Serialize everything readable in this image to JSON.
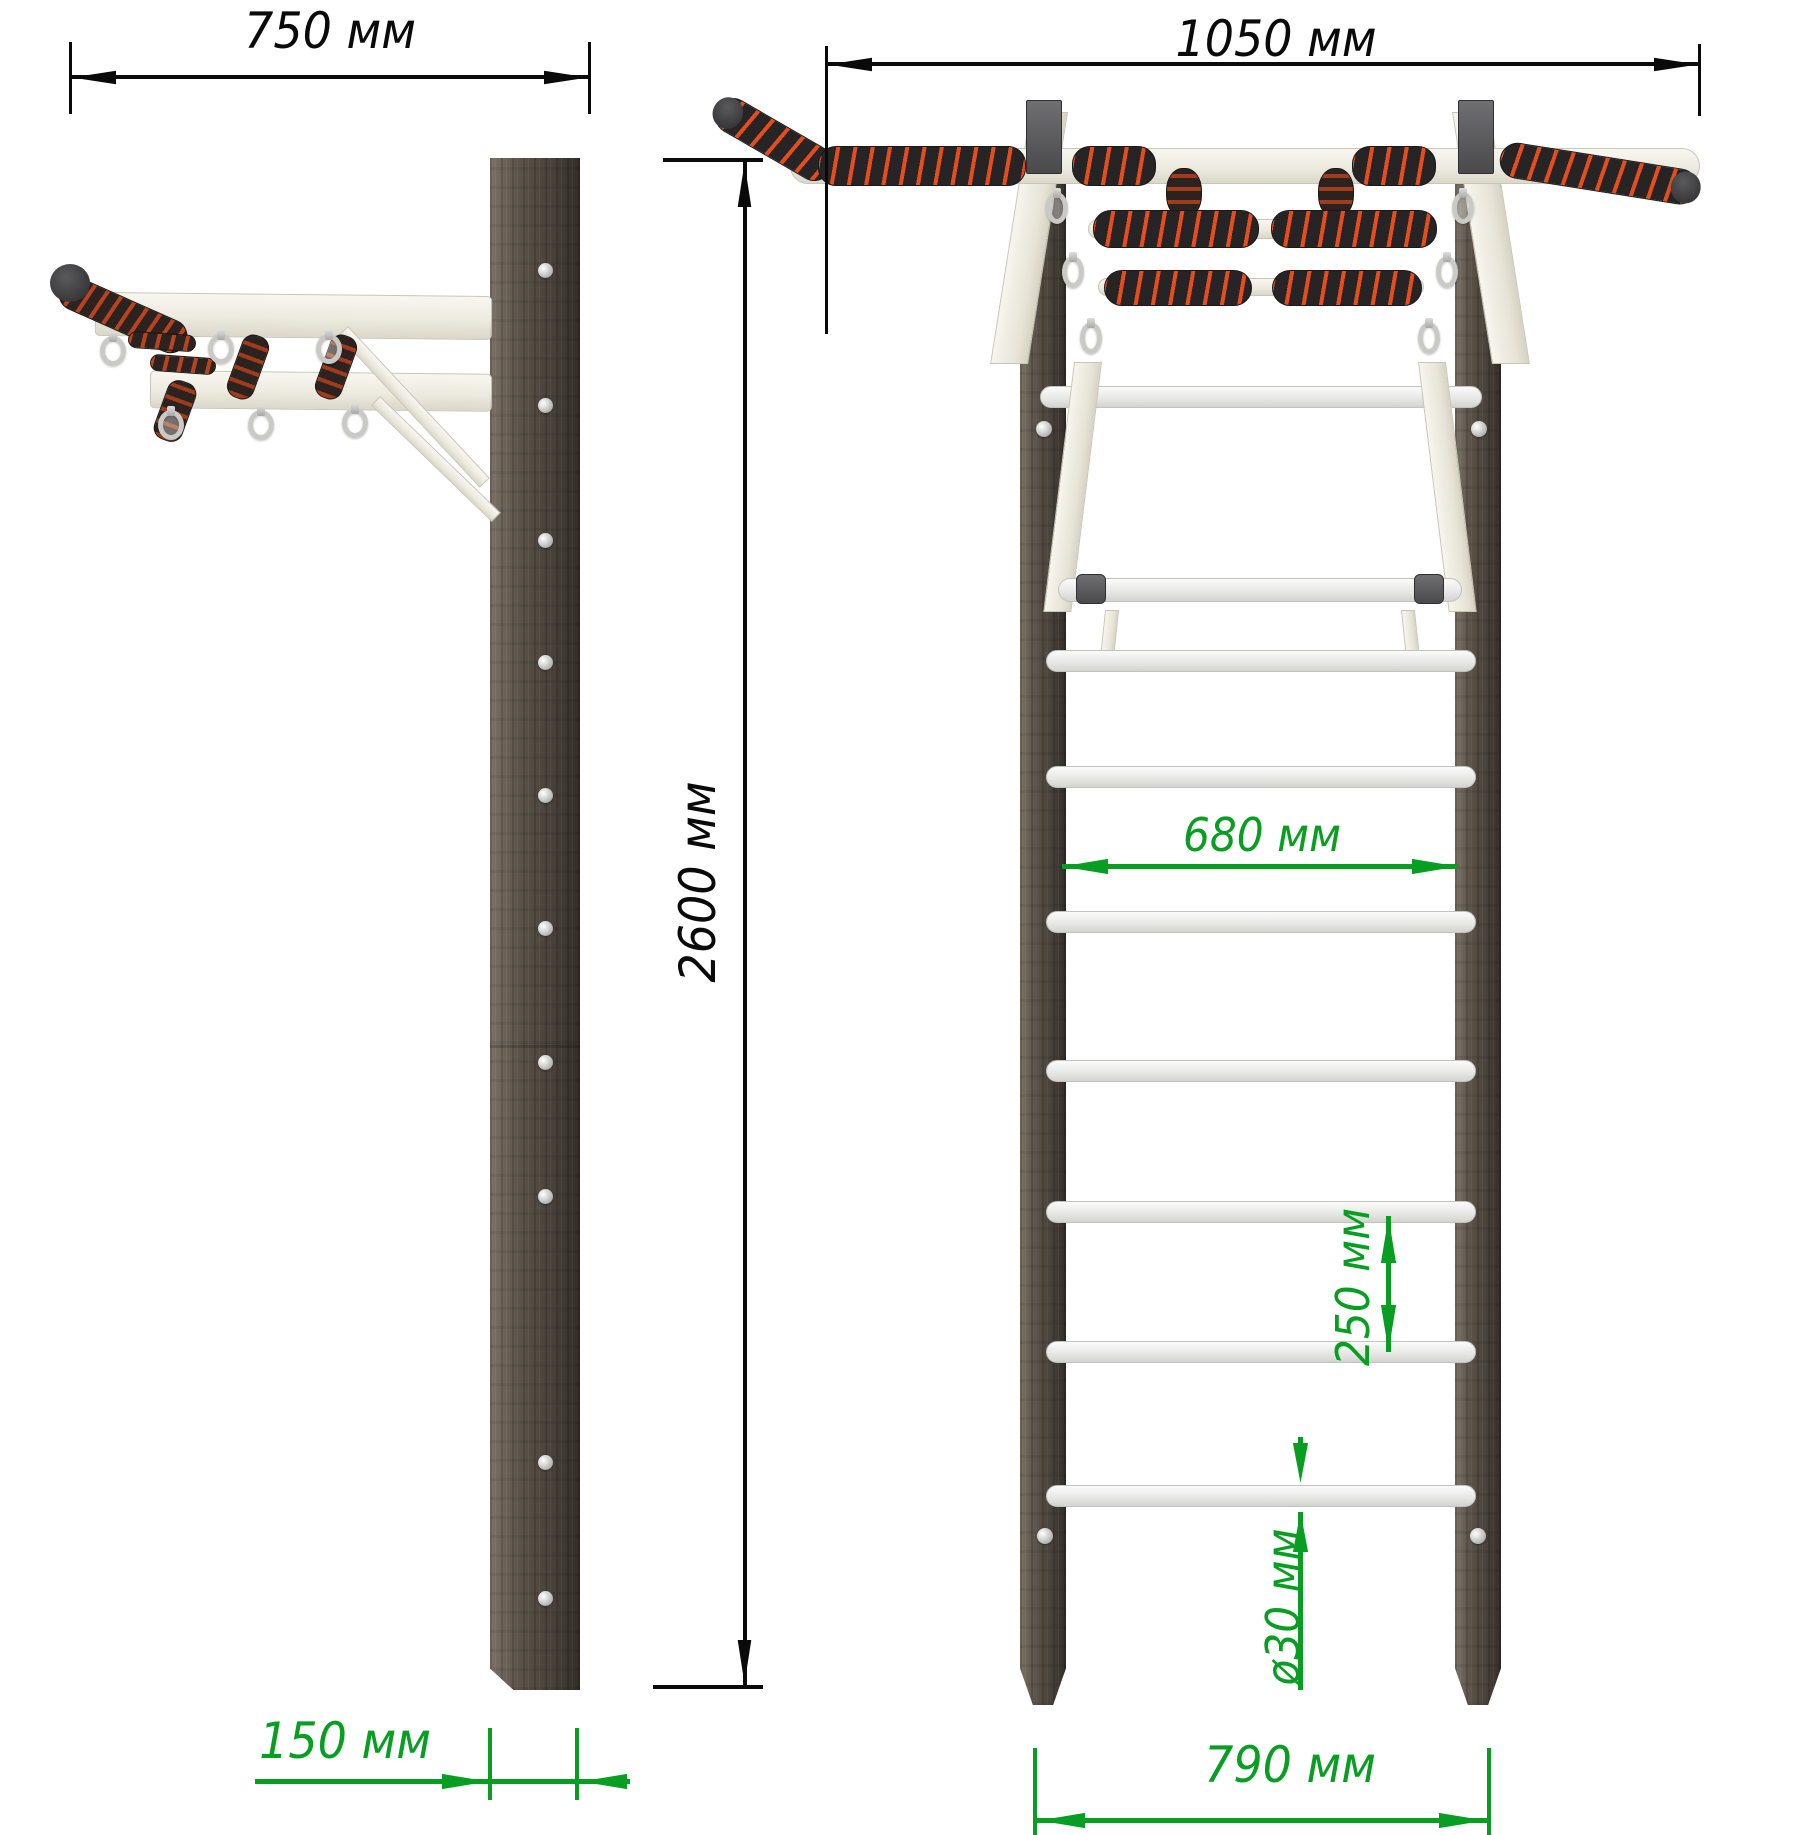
{
  "drawing": {
    "dimensions": {
      "side_width": "750 мм",
      "front_width": "1050 мм",
      "total_height": "2600 мм",
      "rung_clear_width": "680 мм",
      "rung_spacing": "250 мм",
      "rung_diameter": "ø30 мм",
      "wall_offset": "150 мм",
      "ladder_outer_width": "790 мм"
    },
    "colors": {
      "dimension_primary": "#0a0a0a",
      "dimension_secondary": "#089e22",
      "frame_metal": "#f2f0e8",
      "wood": "#554e46",
      "grip_dark": "#262424",
      "grip_accent": "#e64d1d"
    }
  }
}
